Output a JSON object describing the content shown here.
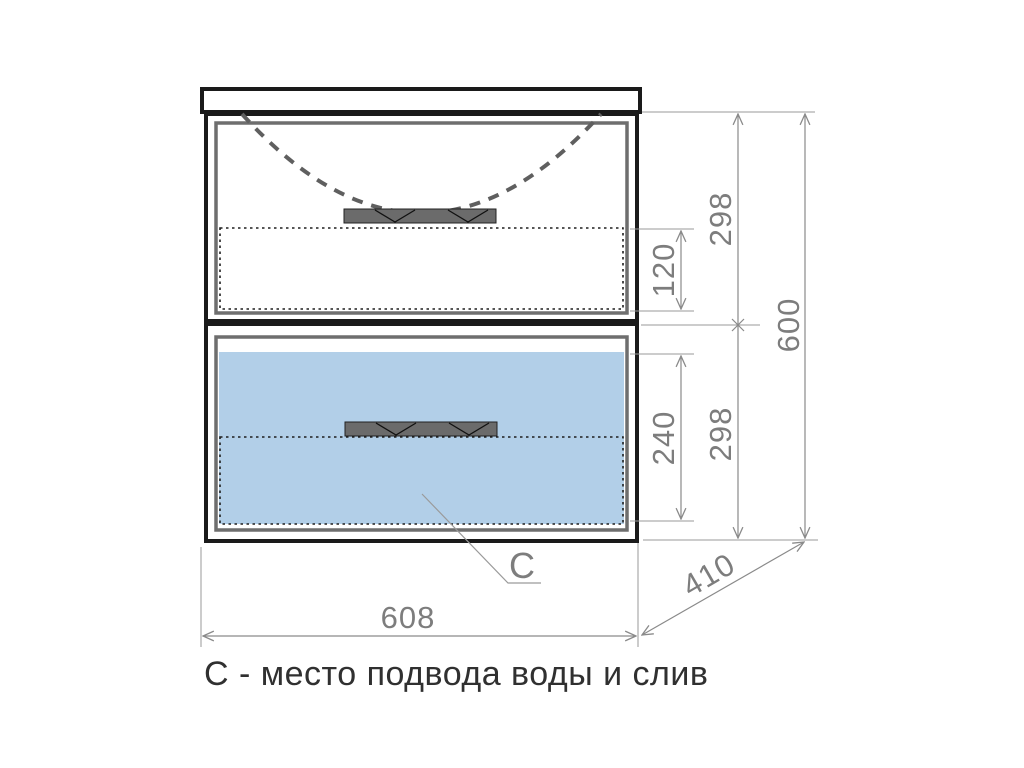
{
  "drawing": {
    "type": "furniture-dimension-drawing",
    "caption": "С - место подвода воды и слив",
    "labels": {
      "width": "608",
      "depth": "410",
      "overall_height": "600",
      "top_drawer_height": "298",
      "bottom_drawer_height": "298",
      "top_drawer_inner": "120",
      "bottom_drawer_inner": "240",
      "leader": "C"
    },
    "colors": {
      "highlight_blue": "#b2cfe8",
      "handle_gray": "#6b6b6b",
      "dimension_gray": "#8a8a8a",
      "outline_black": "#1a1a1a",
      "caption_color": "#303030"
    }
  }
}
